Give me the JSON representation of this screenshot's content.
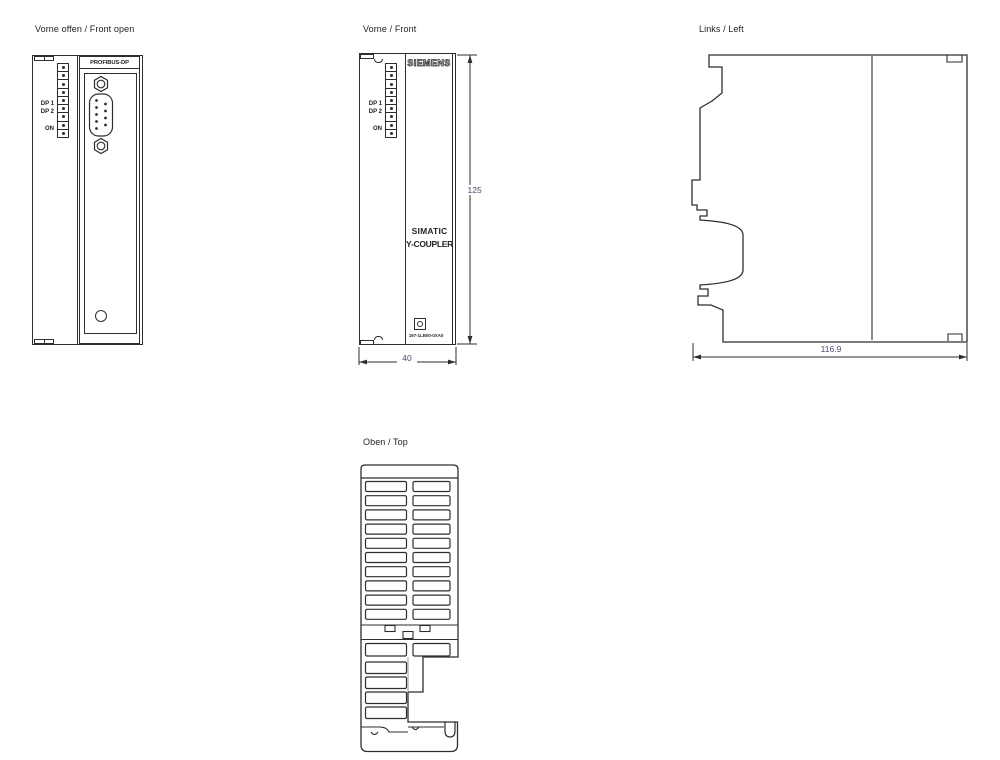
{
  "palette": {
    "line": "#2e2e2e",
    "dimension_text": "#4a4a70",
    "background": "#ffffff"
  },
  "views": {
    "front_open": {
      "title": "Vorne offen / Front open",
      "connector_label": "PROFIBUS-DP",
      "leds": {
        "dp1": "DP 1",
        "dp2": "DP 2",
        "on": "ON"
      }
    },
    "front": {
      "title": "Vorne / Front",
      "brand": "SIEMENS",
      "leds": {
        "dp1": "DP 1",
        "dp2": "DP 2",
        "on": "ON"
      },
      "product": {
        "line1": "SIMATIC",
        "line2": "Y-COUPLER"
      },
      "order_number": "197-1LB00-0XA0",
      "dimensions": {
        "height_mm": "125",
        "width_mm": "40"
      }
    },
    "left": {
      "title": "Links / Left",
      "dimensions": {
        "depth_mm": "116.9"
      }
    },
    "top": {
      "title": "Oben / Top"
    }
  }
}
